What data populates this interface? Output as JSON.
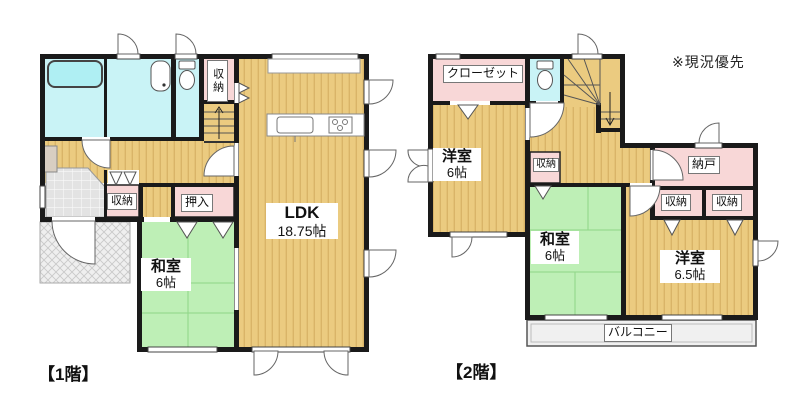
{
  "note": "※現況優先",
  "floor1": {
    "caption": "【1階】",
    "rooms": {
      "ldk": {
        "name": "LDK",
        "size": "18.75帖"
      },
      "washitsu": {
        "name": "和室",
        "size": "6帖"
      },
      "oshiire": "押入",
      "shuno_top": "収納",
      "shuno_hall": "収納"
    },
    "fixtures": [
      "bathtub",
      "washbasin",
      "toilet",
      "kitchen-sink",
      "kitchen-stove",
      "stairs-up"
    ]
  },
  "floor2": {
    "caption": "【2階】",
    "rooms": {
      "closet": "クローゼット",
      "yoshitsu6": {
        "name": "洋室",
        "size": "6帖"
      },
      "washitsu": {
        "name": "和室",
        "size": "6帖"
      },
      "yoshitsu65": {
        "name": "洋室",
        "size": "6.5帖"
      },
      "nando": "納戸",
      "shuno_hall": "収納",
      "shuno_left": "収納",
      "shuno_right": "収納",
      "balcony": "バルコニー"
    },
    "fixtures": [
      "toilet",
      "stairs-down"
    ]
  },
  "colors": {
    "wall": "#1A1A1A",
    "wood_floor": "#EBCB80",
    "wood_stripe": "#D9B468",
    "tatami": "#BEEFB6",
    "water_rooms": "#C9F3F6",
    "storage_pink": "#F8D7D7",
    "entrance_gray": "#E3E3E3",
    "porch_gray": "#EFEFEF"
  }
}
